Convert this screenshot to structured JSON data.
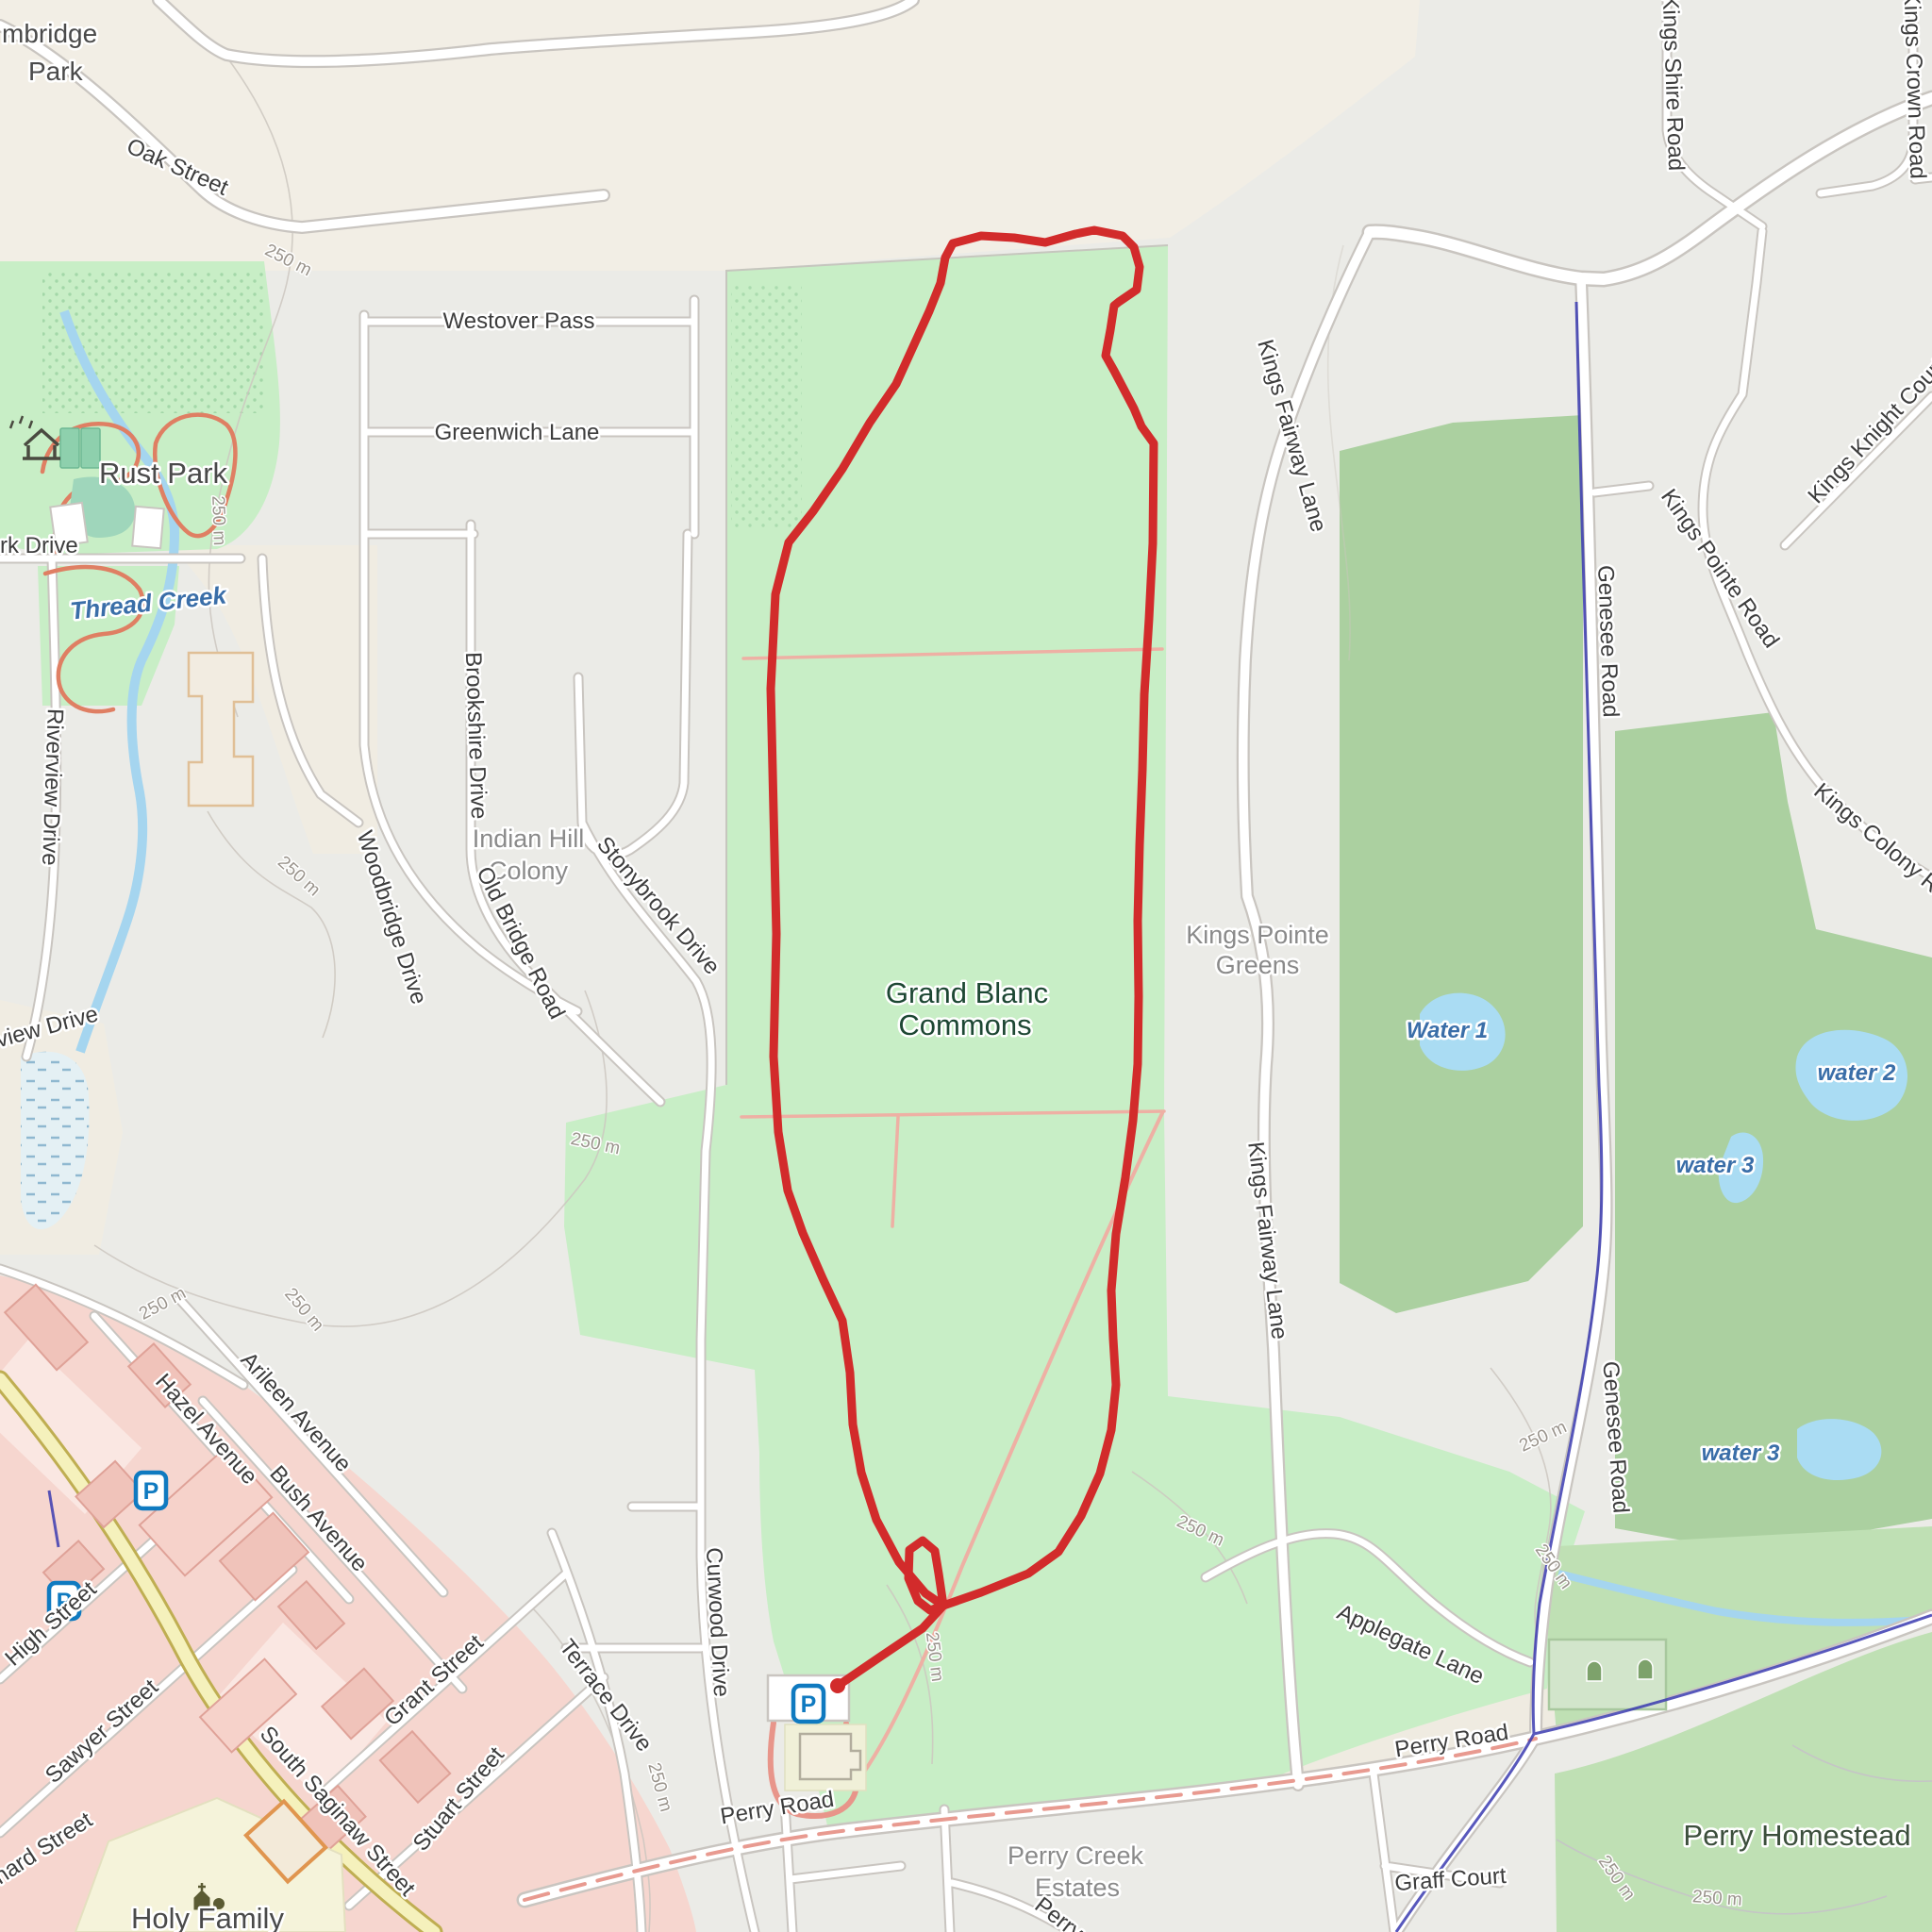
{
  "map": {
    "type": "openstreetmap-style trail map with GPS route overlay",
    "route": {
      "color": "#d22b2b",
      "has_start_marker": true,
      "shape": "loop through Grand Blanc Commons starting at parking lot"
    },
    "colors": {
      "park_green": "#c8eec6",
      "golf_green": "#abd0a0",
      "water_blue": "#aadcf3",
      "route_red": "#d22b2b",
      "admin_boundary_blue": "#3b3bb0",
      "commercial_pink": "#f6d6cf",
      "saginaw_yellow": "#f5f1bc",
      "beige_land": "#f2eee5",
      "salmon_path": "#eeb0a4"
    }
  },
  "labels": {
    "cambridge_park_line1": "mbridge",
    "cambridge_park_line2": "Park",
    "oak_street": "Oak Street",
    "westover_pass": "Westover Pass",
    "greenwich_lane": "Greenwich Lane",
    "rust_park": "Rust Park",
    "thread_creek": "Thread Creek",
    "park_drive_partial": "rk Drive",
    "riverview_drive": "Riverview Drive",
    "view_drive_partial": "view Drive",
    "brookshire_drive": "Brookshire Drive",
    "indian_hill_line1": "Indian Hill",
    "indian_hill_line2": "Colony",
    "woodbridge_drive": "Woodbridge Drive",
    "old_bridge_road": "Old Bridge Road",
    "stonybrook_drive": "Stonybrook Drive",
    "grand_blanc_commons_line1": "Grand Blanc",
    "grand_blanc_commons_line2": "Commons",
    "kings_fairway_lane": "Kings Fairway Lane",
    "kings_pointe_greens_line1": "Kings Pointe",
    "kings_pointe_greens_line2": "Greens",
    "genesee_road": "Genesee Road",
    "kings_shire_road": "Kings Shire Road",
    "kings_crown_road": "Kings Crown Road",
    "kings_knight_court": "Kings Knight Court",
    "kings_pointe_road": "Kings Pointe Road",
    "kings_colony_road": "Kings Colony Road",
    "water_1": "Water 1",
    "water_2": "water 2",
    "water_3": "water 3",
    "hazel_avenue": "Hazel Avenue",
    "arileen_avenue": "Arileen Avenue",
    "bush_avenue": "Bush Avenue",
    "high_street": "High Street",
    "sawyer_street": "Sawyer Street",
    "south_saginaw_street": "South Saginaw Street",
    "grant_street": "Grant Street",
    "stuart_street": "Stuart Street",
    "terrace_drive": "Terrace Drive",
    "curwood_drive": "Curwood Drive",
    "holy_family": "Holy Family",
    "hard_street_partial": "hard Street",
    "perry_road": "Perry Road",
    "perry_creek_estates_line1": "Perry Creek",
    "perry_creek_estates_line2": "Estates",
    "perry_homestead": "Perry Homestead",
    "graff_court": "Graff Court",
    "applegate_lane": "Applegate Lane",
    "perry_partial": "Perry",
    "contour": "250 m",
    "parking": "P"
  }
}
